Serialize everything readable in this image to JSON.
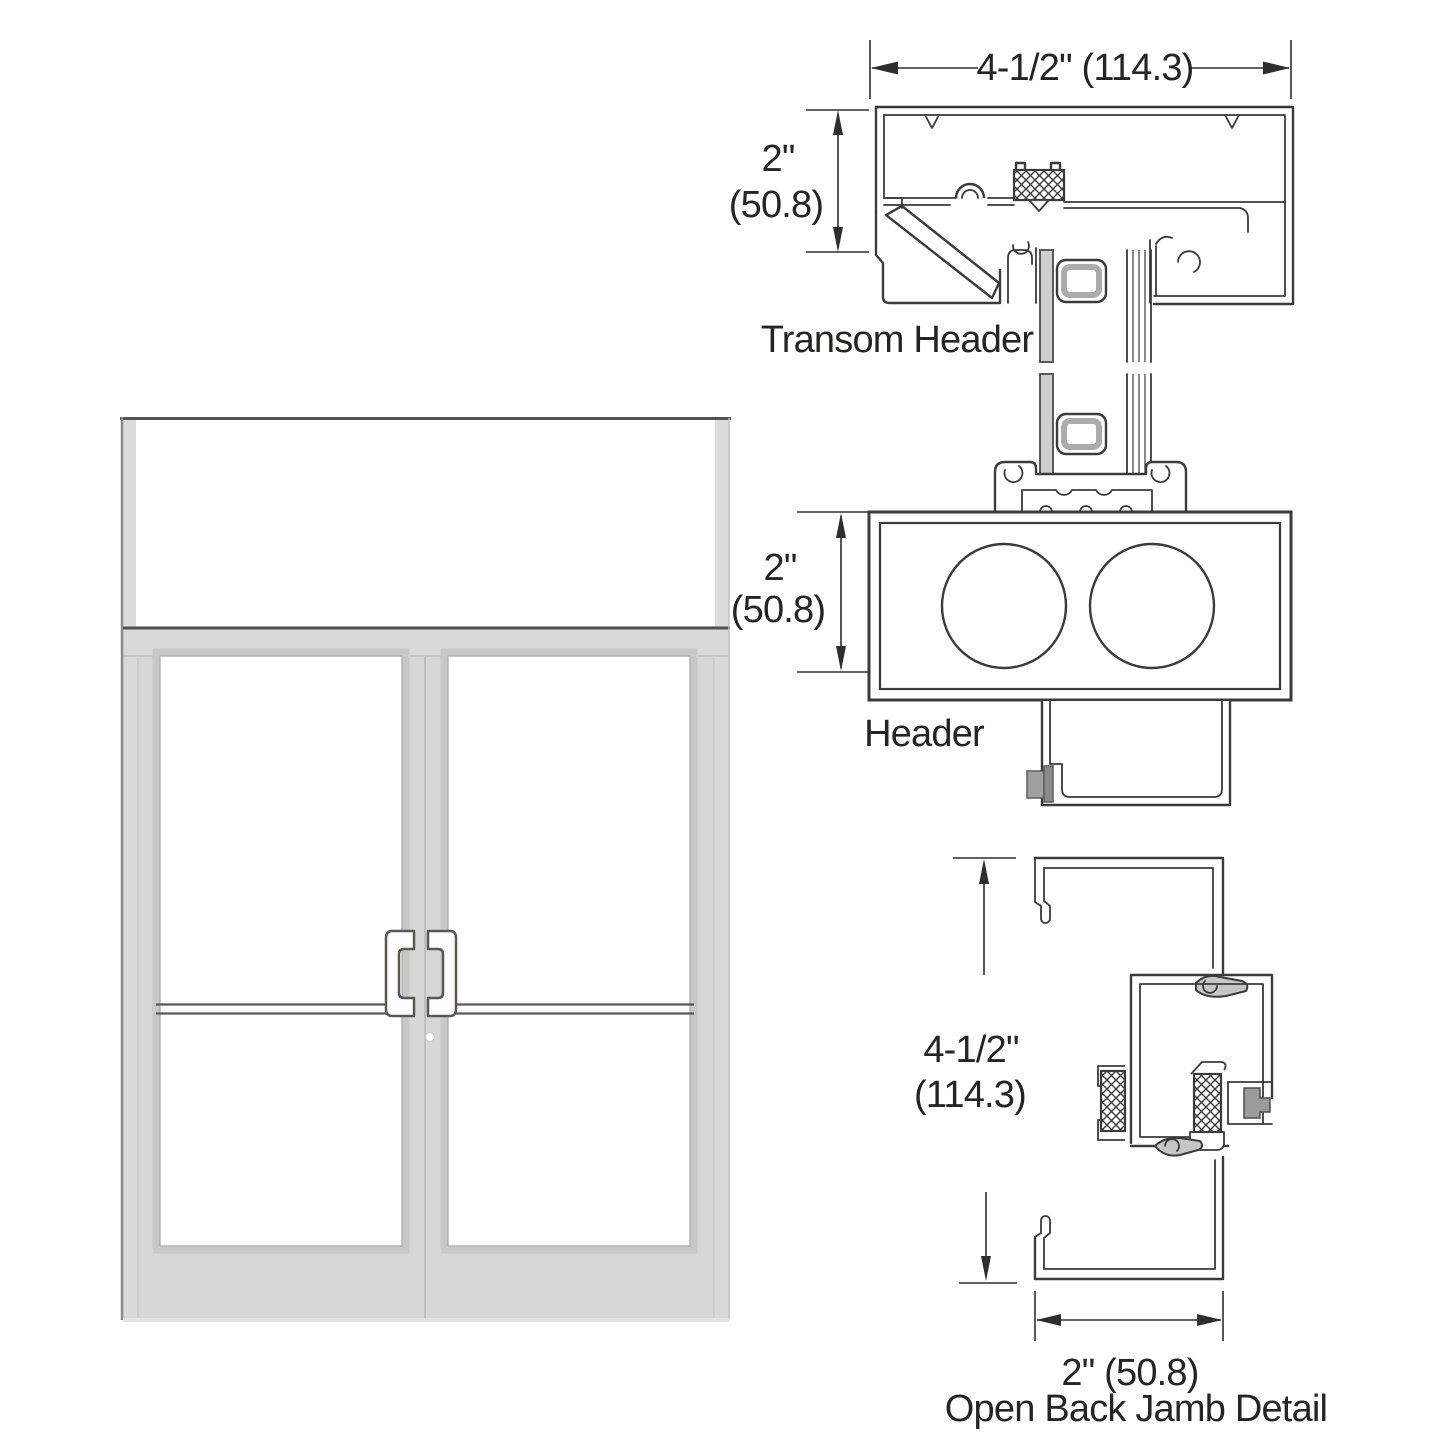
{
  "labels": {
    "transom_header": "Transom Header",
    "header": "Header",
    "open_back_jamb": "Open Back Jamb Detail"
  },
  "dimensions": {
    "frame_width": "4-1/2\" (114.3)",
    "transom_face_height_in": "2\"",
    "transom_face_height_mm": "(50.8)",
    "header_face_height_in": "2\"",
    "header_face_height_mm": "(50.8)",
    "jamb_depth_in": "4-1/2\"",
    "jamb_depth_mm": "(114.3)",
    "jamb_width": "2\" (50.8)"
  },
  "colors": {
    "line_color": "#3b3b39",
    "dim_color": "#2e2e2c",
    "text_color": "#242422",
    "frame_gray": "#d7d7d5",
    "glass_pane_gray": "#cfcfcd",
    "bumper_gray": "#9c9c9a",
    "background": "#ffffff"
  }
}
